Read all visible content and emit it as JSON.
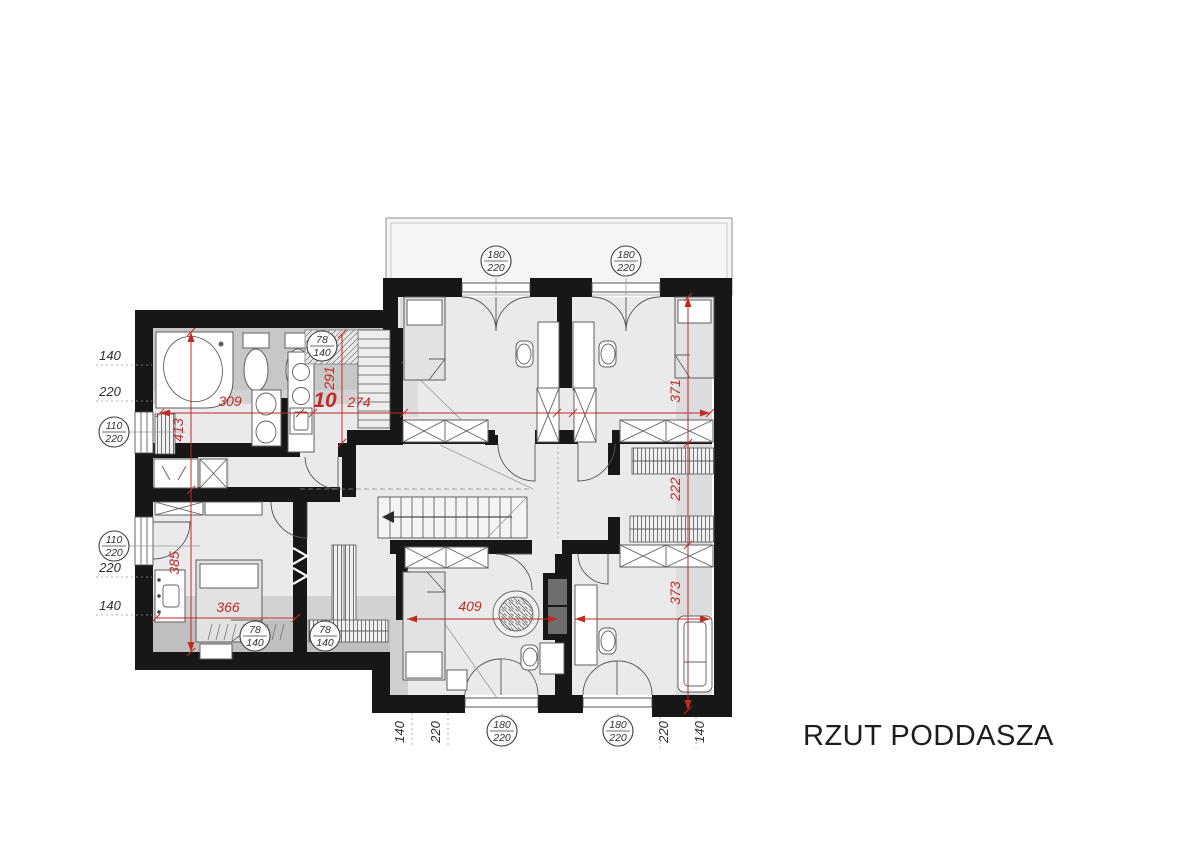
{
  "title": "RZUT PODDASZA",
  "dims": {
    "d309": "309",
    "d413": "413",
    "d291": "291",
    "d274": "274",
    "d10": "10",
    "d371": "371",
    "d222": "222",
    "d373": "373",
    "d409": "409",
    "d385": "385",
    "d366": "366"
  },
  "stamps": {
    "door_terrace_left": {
      "top": "180",
      "bot": "220"
    },
    "door_terrace_right": {
      "top": "180",
      "bot": "220"
    },
    "window_left_top": {
      "top": "110",
      "bot": "220"
    },
    "window_left_bottom": {
      "top": "110",
      "bot": "220"
    },
    "roof_window_kitchen": {
      "top": "78",
      "bot": "140"
    },
    "roof_window_bed_1": {
      "top": "78",
      "bot": "140"
    },
    "roof_window_bed_2": {
      "top": "78",
      "bot": "140"
    },
    "door_bottom_left": {
      "top": "180",
      "bot": "220"
    },
    "door_bottom_right": {
      "top": "180",
      "bot": "220"
    }
  },
  "edge": {
    "left": [
      "140",
      "220",
      "220",
      "140"
    ],
    "bottom": [
      "140",
      "220",
      "220",
      "140"
    ]
  },
  "colors": {
    "dimension_red": "#c02a23",
    "wall_black": "#171717"
  }
}
